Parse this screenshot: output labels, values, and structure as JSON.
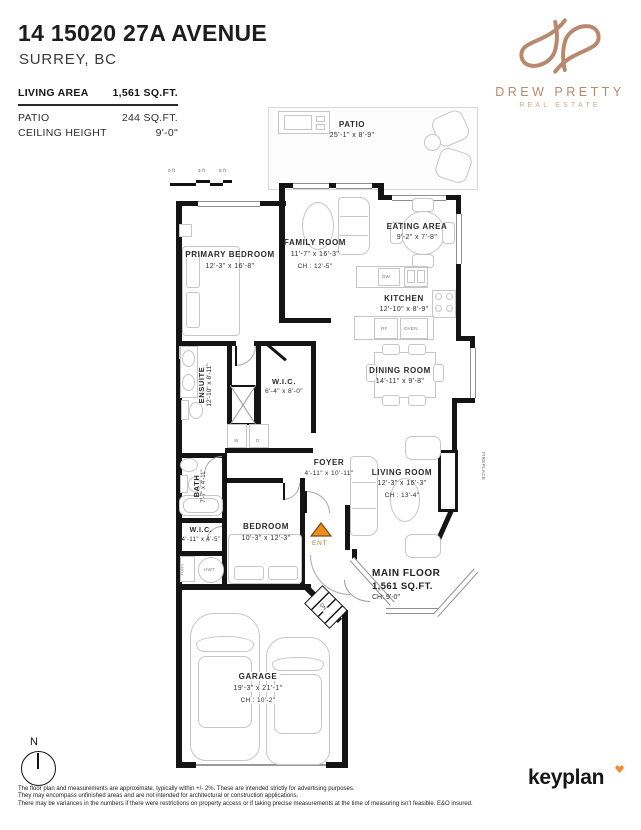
{
  "header": {
    "title": "14 15020 27A AVENUE",
    "subtitle": "SURREY, BC"
  },
  "stats": {
    "living_area_label": "LIVING AREA",
    "living_area_value": "1,561 SQ.FT.",
    "patio_label": "PATIO",
    "patio_value": "244 SQ.FT.",
    "ceiling_label": "CEILING HEIGHT",
    "ceiling_value": "9'-0\""
  },
  "brand": {
    "name": "DREW PRETTY",
    "tagline": "REAL ESTATE",
    "color": "#b8896f"
  },
  "scale_bar": {
    "zero": "0 ft",
    "three": "3 ft",
    "five": "5 ft"
  },
  "rooms": {
    "patio": {
      "name": "PATIO",
      "dims": "25'-1\" x 8'-9\""
    },
    "family_room": {
      "name": "FAMILY ROOM",
      "dims": "11'-7\" x 16'-3\"",
      "ch": "CH : 12'-5\""
    },
    "eating_area": {
      "name": "EATING AREA",
      "dims": "9'-2\" x 7'-8\""
    },
    "kitchen": {
      "name": "KITCHEN",
      "dims": "12'-10\" x 8'-9\""
    },
    "primary_bedroom": {
      "name": "PRIMARY BEDROOM",
      "dims": "12'-3\" x 16'-8\""
    },
    "ensuite": {
      "name": "ENSUITE",
      "dims": "12'-10\" x 8'-11\""
    },
    "wic_primary": {
      "name": "W.I.C.",
      "dims": "6'-4\" x 8'-0\""
    },
    "dining_room": {
      "name": "DINING ROOM",
      "dims": "14'-11\" x 9'-8\""
    },
    "foyer": {
      "name": "FOYER",
      "dims": "4'-11\" x 10'-11\""
    },
    "living_room": {
      "name": "LIVING ROOM",
      "dims": "12'-3\" x 16'-3\"",
      "ch": "CH : 13'-4\""
    },
    "bath": {
      "name": "BATH",
      "dims": "7'-7\" x 4'-11\""
    },
    "wic_hall": {
      "name": "W.I.C.",
      "dims": "4'-11\" x 4'-5\""
    },
    "bedroom": {
      "name": "BEDROOM",
      "dims": "10'-3\" x 12'-3\""
    },
    "main_floor": {
      "name": "MAIN FLOOR",
      "area": "1,561 SQ.FT.",
      "ch": "CH: 9'-0\""
    },
    "garage": {
      "name": "GARAGE",
      "dims": "19'-3\" x 21'-1\"",
      "ch": "CH : 10'-2\""
    }
  },
  "fixtures": {
    "dw": "DW",
    "rf": "RF",
    "oven": "OVEN",
    "washer": "W",
    "dryer": "D",
    "furnace": "FURN",
    "hwt": "HWT",
    "fireplace": "FIREPLACE",
    "entry": "ENT",
    "down": "DN"
  },
  "compass": {
    "label": "N"
  },
  "footer": {
    "logo": "keyplan",
    "disclaimer": [
      "The floor plan and measurements are approximate, typically within +/- 2%. These are intended strictly for advertising purposes.",
      "They may encompass unfinished areas and are not intended for architectural or construction applications.",
      "There may be variances in the numbers if there were restrictions on property access or if taking precise measurements at the time of measuring isn't feasible. E&O insured."
    ]
  }
}
